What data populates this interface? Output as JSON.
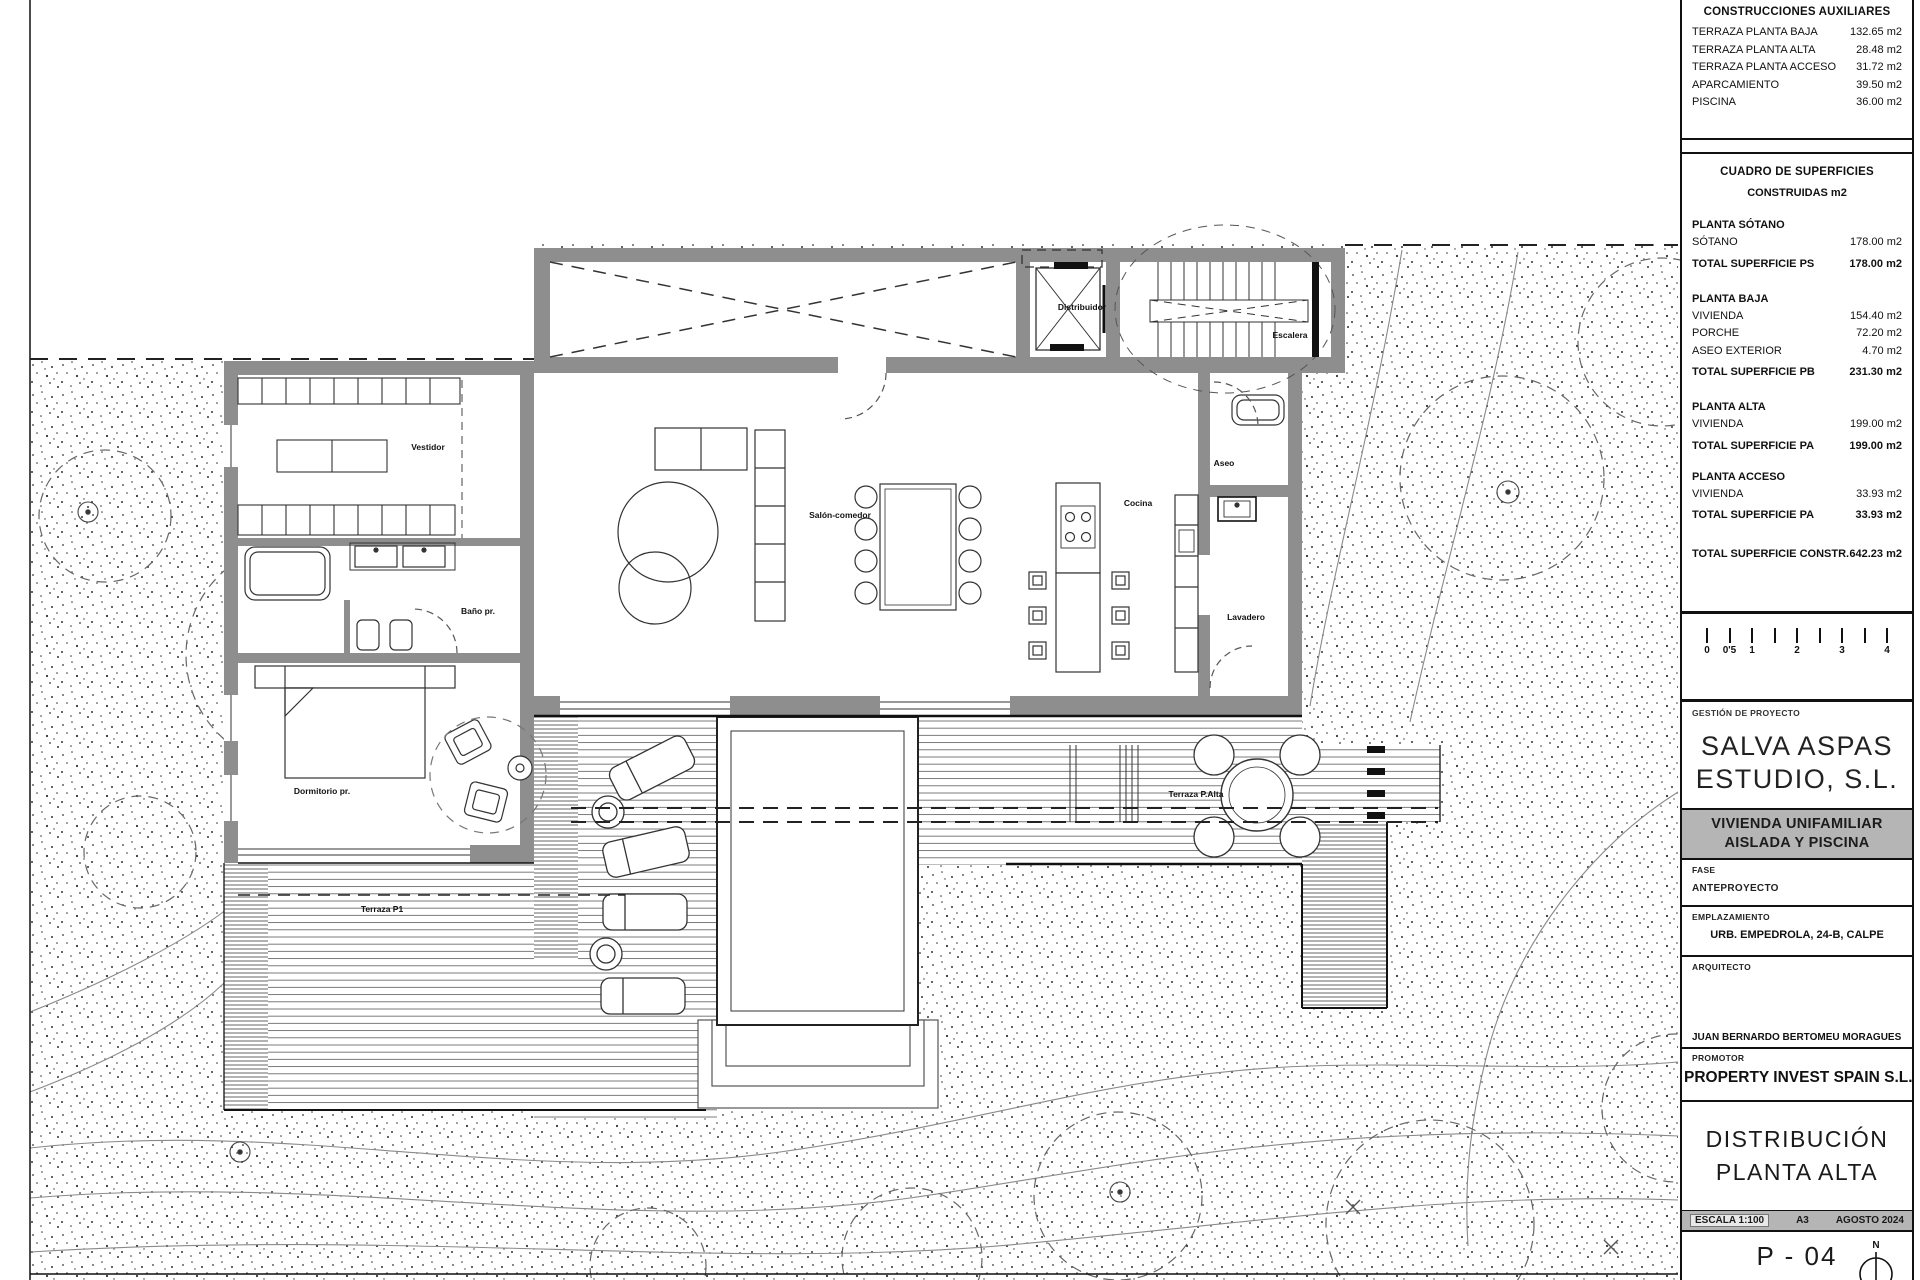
{
  "title_block": {
    "aux_table": {
      "title": "CONSTRUCCIONES AUXILIARES",
      "rows": [
        {
          "label": "TERRAZA PLANTA BAJA",
          "value": "132.65 m2"
        },
        {
          "label": "TERRAZA PLANTA ALTA",
          "value": "28.48 m2"
        },
        {
          "label": "TERRAZA PLANTA ACCESO",
          "value": "31.72 m2"
        },
        {
          "label": "APARCAMIENTO",
          "value": "39.50 m2"
        },
        {
          "label": "PISCINA",
          "value": "36.00 m2"
        }
      ]
    },
    "surfaces_table": {
      "title": "CUADRO DE SUPERFICIES",
      "subtitle": "CONSTRUIDAS m2",
      "g0_heading": "PLANTA SÓTANO",
      "g0_r0": {
        "label": "SÓTANO",
        "value": "178.00 m2"
      },
      "g0_total": {
        "label": "TOTAL SUPERFICIE PS",
        "value": "178.00 m2"
      },
      "g1_heading": "PLANTA BAJA",
      "g1_r0": {
        "label": "VIVIENDA",
        "value": "154.40 m2"
      },
      "g1_r1": {
        "label": "PORCHE",
        "value": "72.20 m2"
      },
      "g1_r2": {
        "label": "ASEO EXTERIOR",
        "value": "4.70 m2"
      },
      "g1_total": {
        "label": "TOTAL SUPERFICIE PB",
        "value": "231.30 m2"
      },
      "g2_heading": "PLANTA ALTA",
      "g2_r0": {
        "label": "VIVIENDA",
        "value": "199.00 m2"
      },
      "g2_total": {
        "label": "TOTAL SUPERFICIE PA",
        "value": "199.00 m2"
      },
      "g3_heading": "PLANTA ACCESO",
      "g3_r0": {
        "label": "VIVIENDA",
        "value": "33.93 m2"
      },
      "g3_total": {
        "label": "TOTAL SUPERFICIE PA",
        "value": "33.93 m2"
      },
      "grand_total": {
        "label": "TOTAL SUPERFICIE CONSTR.",
        "value": "642.23 m2"
      }
    },
    "scale_bar": {
      "ticks": [
        "0",
        "0'5",
        "1",
        "",
        "2",
        "",
        "3",
        "",
        "4"
      ]
    },
    "management": {
      "label": "GESTIÓN DE PROYECTO",
      "firm_line1": "SALVA ASPAS",
      "firm_line2": "ESTUDIO, S.L."
    },
    "project_banner": {
      "line1": "VIVIENDA UNIFAMILIAR",
      "line2": "AISLADA Y PISCINA"
    },
    "fase": {
      "label": "FASE",
      "value": "ANTEPROYECTO"
    },
    "emplazamiento": {
      "label": "EMPLAZAMIENTO",
      "value": "URB. EMPEDROLA, 24-B, CALPE"
    },
    "arquitecto": {
      "label": "ARQUITECTO",
      "value": "JUAN BERNARDO BERTOMEU MORAGUES"
    },
    "promotor": {
      "label": "PROMOTOR",
      "value": "PROPERTY INVEST SPAIN S.L."
    },
    "drawing_title": {
      "line1": "DISTRIBUCIÓN",
      "line2": "PLANTA ALTA"
    },
    "meta": {
      "escala": "ESCALA 1:100",
      "formato": "A3",
      "fecha": "AGOSTO 2024"
    },
    "sheet_number": "P - 04",
    "north_label": "N"
  },
  "plan": {
    "room_labels": [
      {
        "text": "Vestidor"
      },
      {
        "text": "Baño pr."
      },
      {
        "text": "Dormitorio pr."
      },
      {
        "text": "Salón-comedor"
      },
      {
        "text": "Cocina"
      },
      {
        "text": "Aseo"
      },
      {
        "text": "Lavadero"
      },
      {
        "text": "Distribuidor"
      },
      {
        "text": "Escalera"
      },
      {
        "text": "Terraza P1"
      },
      {
        "text": "Terraza P.Alta"
      }
    ]
  }
}
